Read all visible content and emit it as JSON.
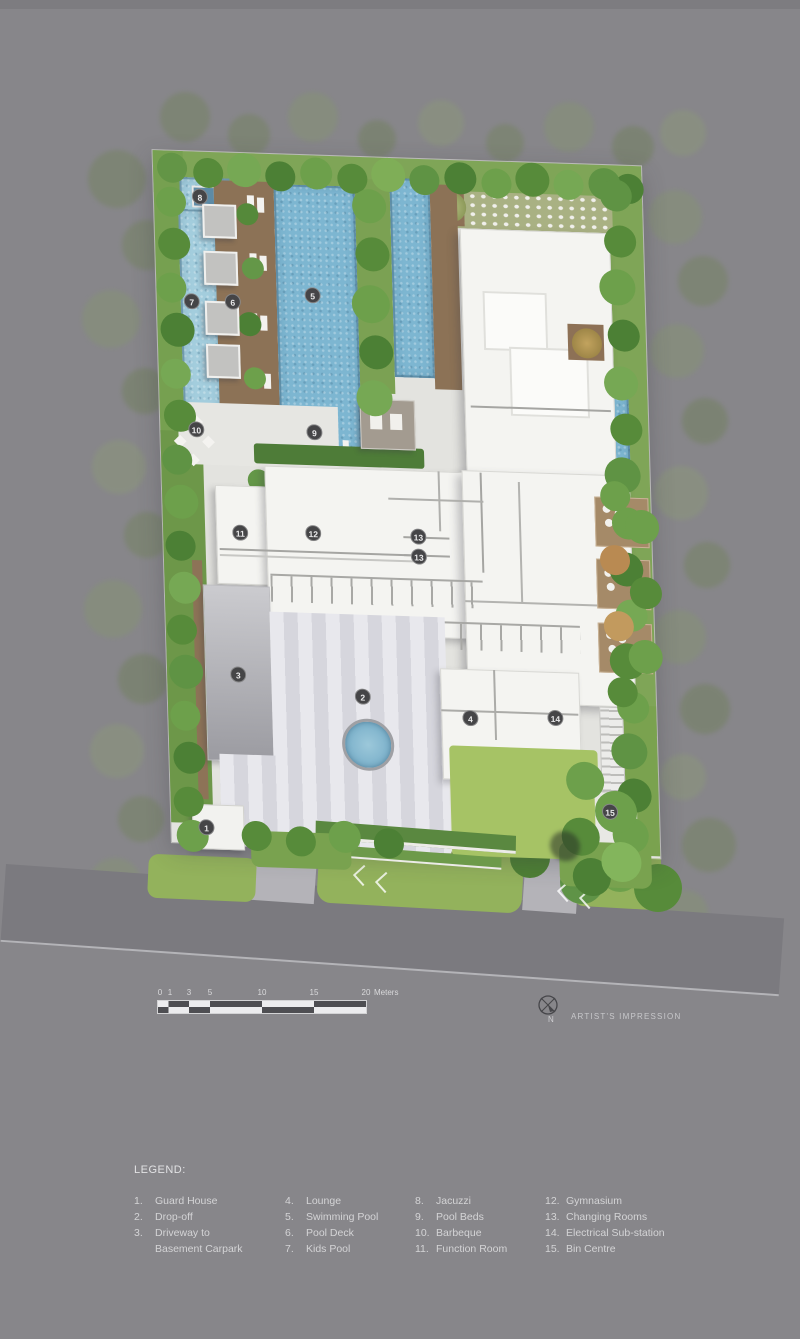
{
  "plan": {
    "markers": [
      "8",
      "7",
      "6",
      "5",
      "9",
      "10",
      "11",
      "12",
      "13",
      "13",
      "3",
      "2",
      "4",
      "14",
      "15",
      "1"
    ]
  },
  "scalebar": {
    "ticks": [
      "0",
      "1",
      "3",
      "5",
      "10",
      "15",
      "20"
    ],
    "unit": "Meters"
  },
  "compass": {
    "north": "N"
  },
  "note": "ARTIST'S IMPRESSION",
  "legend": {
    "title": "LEGEND:",
    "columns": [
      {
        "rows": [
          {
            "num": "1.",
            "label": "Guard House"
          },
          {
            "num": "2.",
            "label": "Drop-off"
          },
          {
            "num": "3.",
            "label": "Driveway to"
          },
          {
            "num": "",
            "label": "Basement Carpark"
          }
        ]
      },
      {
        "rows": [
          {
            "num": "4.",
            "label": "Lounge"
          },
          {
            "num": "5.",
            "label": "Swimming Pool"
          },
          {
            "num": "6.",
            "label": "Pool Deck"
          },
          {
            "num": "7.",
            "label": "Kids Pool"
          }
        ]
      },
      {
        "rows": [
          {
            "num": "8.",
            "label": "Jacuzzi"
          },
          {
            "num": "9.",
            "label": "Pool Beds"
          },
          {
            "num": "10.",
            "label": "Barbeque"
          },
          {
            "num": "11.",
            "label": "Function Room"
          }
        ]
      },
      {
        "rows": [
          {
            "num": "12.",
            "label": "Gymnasium"
          },
          {
            "num": "13.",
            "label": "Changing Rooms"
          },
          {
            "num": "14.",
            "label": "Electrical Sub-station"
          },
          {
            "num": "15.",
            "label": "Bin Centre"
          }
        ]
      }
    ]
  },
  "colors": {
    "background": "#87868a",
    "road": "#7b7a7f",
    "pool_water": "#7db6d1",
    "kids_pool": "#a3cddd",
    "greenery": "#6da04b",
    "pool_deck": "#8c7256",
    "building": "#f4f4f1",
    "lawn": "#a6c365",
    "marker_badge": "#454547",
    "legend_text": "#d4d4d6"
  }
}
